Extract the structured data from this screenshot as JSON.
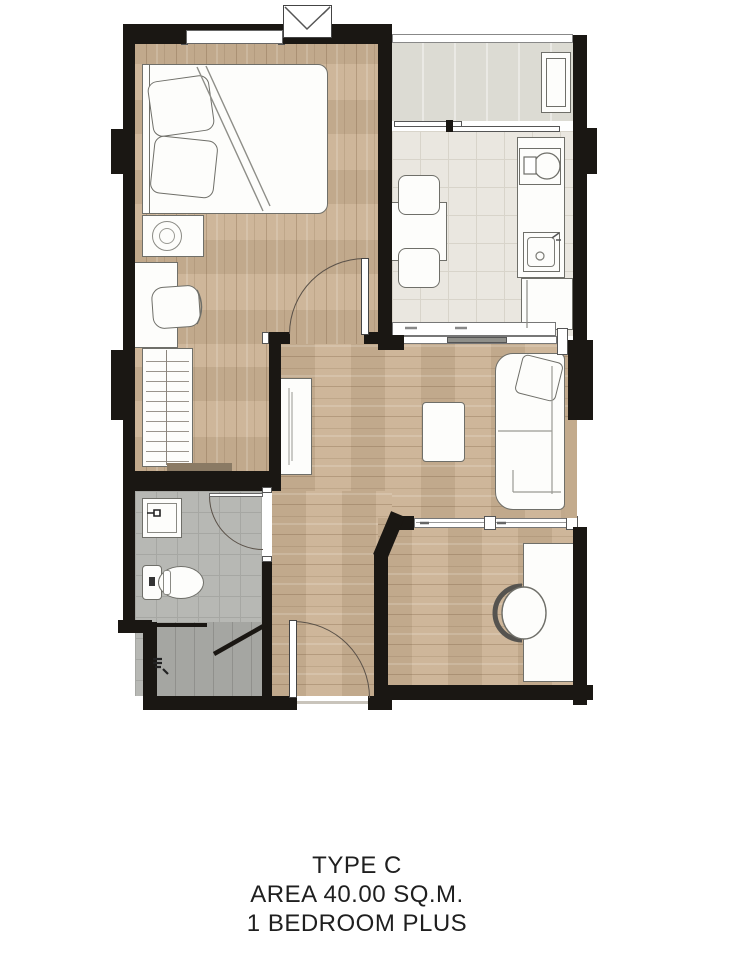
{
  "caption": {
    "line1": "TYPE C",
    "line2": "AREA 40.00 SQ.M.",
    "line3": "1 BEDROOM PLUS"
  },
  "palette": {
    "wall": "#1a1713",
    "wood": "#cbb294",
    "kitchen_tile": "#eae7e0",
    "kitchen_tile_line": "#d8d4ca",
    "bath_tile": "#b7b8b4",
    "bath_tile_line": "#a6a7a3",
    "shower_tile": "#aeafab",
    "balcony_floor": "#dcdbd3",
    "furniture_fill": "#fdfdfb",
    "furniture_line": "#6f6f69",
    "arc": "#5a5148",
    "sketch": "#8e8e88",
    "wood_bar": "#8a7a64",
    "wall_tan": "#c3ab8d",
    "text": "#1f1f1f",
    "page": "#ffffff"
  }
}
